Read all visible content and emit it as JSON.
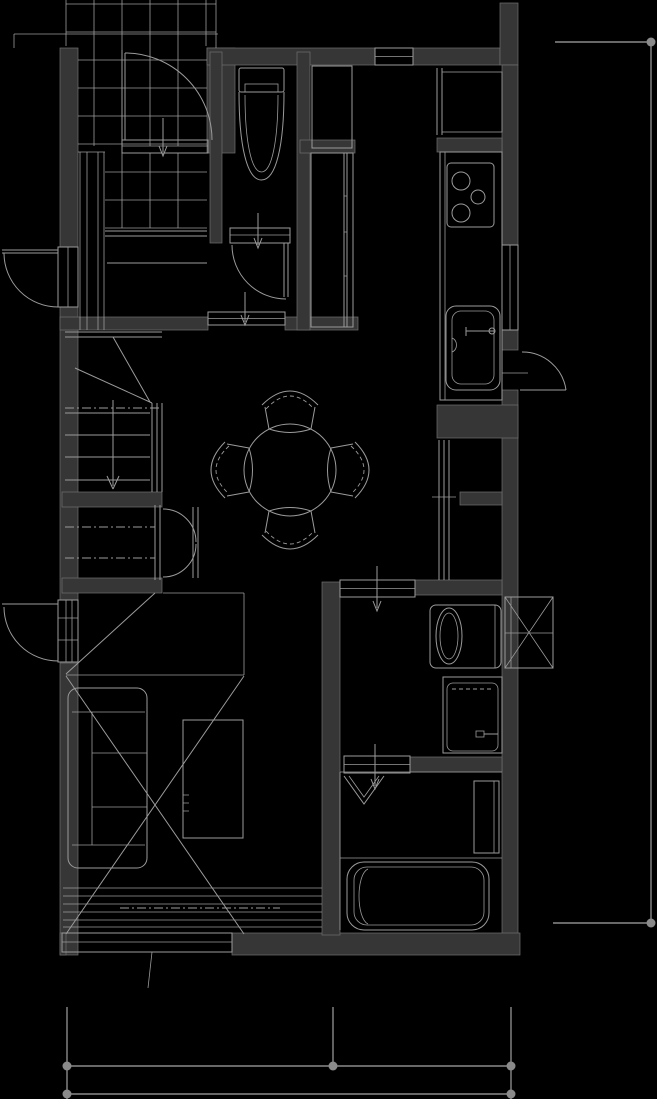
{
  "canvas": {
    "width": 657,
    "height": 1099,
    "background": "#000000"
  },
  "palette": {
    "wall": "#363636",
    "wall_edge": "#6f6f6f",
    "line": "#9b9b9b",
    "dimension": "#8a8a8a"
  },
  "drawing": {
    "kind": "architectural-floor-plan",
    "visible_text": [],
    "areas": [
      {
        "name": "entrance-porch",
        "features": [
          "tile-grid",
          "outswing-entry-door",
          "entry-direction-arrow"
        ]
      },
      {
        "name": "entrance-hall",
        "features": [
          "tile-grid",
          "step-edge-lines",
          "tall-side-cabinet"
        ]
      },
      {
        "name": "toilet-room",
        "features": [
          "toilet-with-tank",
          "hinged-door-arc",
          "direction-arrow"
        ]
      },
      {
        "name": "storage-closets",
        "features": [
          "upper-cabinet",
          "tall-closet-with-sliding-panel"
        ]
      },
      {
        "name": "kitchen",
        "features": [
          "refrigerator-alcove",
          "counter",
          "three-burner-stove",
          "kitchen-sink-with-faucet",
          "window-top-wall",
          "window-right-wall",
          "service-door-arc"
        ]
      },
      {
        "name": "dining-area",
        "features": [
          "round-table",
          "four-chairs",
          "sliding-door-threshold"
        ]
      },
      {
        "name": "staircase",
        "features": [
          "treads",
          "break-line",
          "dash-dot-cut-line",
          "handrail",
          "down-arrow"
        ]
      },
      {
        "name": "hall-closet",
        "features": [
          "double-swing-doors",
          "dash-dot-rod-lines"
        ]
      },
      {
        "name": "living-bedroom",
        "features": [
          "sofa-three-cushion",
          "low-table",
          "floor-cross-mark",
          "corner-closet-diagonal",
          "deck-stripe-band",
          "bottom-window",
          "outswing-side-door"
        ]
      },
      {
        "name": "washroom",
        "features": [
          "washing-machine",
          "vanity-sink",
          "two-sliding-doors-with-arrows",
          "bay-box-cross-mark"
        ]
      },
      {
        "name": "bathroom",
        "features": [
          "bathtub",
          "folding-door",
          "side-counter"
        ]
      }
    ],
    "doors": {
      "hinged_arc_doors": 5,
      "sliding_thresholds": 4,
      "double_swing_closet_doors": 1,
      "folding_doors": 1
    },
    "dimension_lines": {
      "right_vertical": {
        "endpoint_dots": 2,
        "labels": []
      },
      "bottom_upper": {
        "endpoint_dots": 3,
        "labels": []
      },
      "bottom_lower": {
        "endpoint_dots": 2,
        "labels": []
      }
    }
  }
}
